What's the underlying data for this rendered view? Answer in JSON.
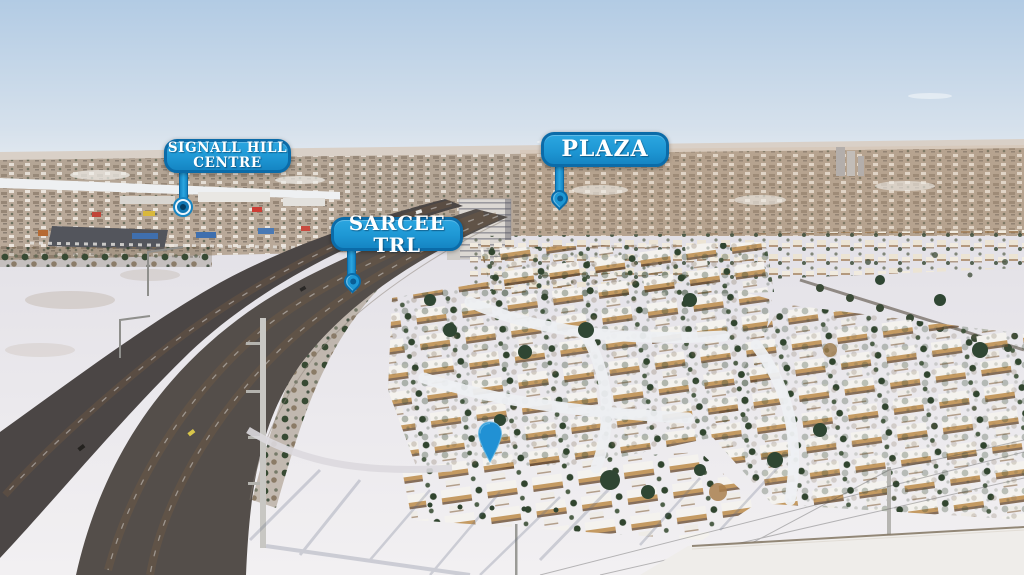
{
  "callouts": {
    "signal_hill": {
      "line1": "SIGNALL HILL",
      "line2": "CENTRE"
    },
    "sarcee_trl": {
      "text": "SARCEE TRL"
    },
    "plaza": {
      "text": "PLAZA"
    }
  },
  "markers": {
    "property_pin_icon": "location-pin",
    "signal_hill_pin_icon": "circle-pin",
    "sarcee_trl_pin_icon": "teardrop-pin",
    "plaza_pin_icon": "teardrop-pin"
  },
  "colors": {
    "callout_fill": "#1e97d4",
    "callout_border": "#0b6ba8",
    "callout_text": "#ffffff",
    "pin_blue": "#2191d4",
    "sky": "#b2cbe4",
    "snow": "#eceaee",
    "asphalt": "#4e4947"
  }
}
